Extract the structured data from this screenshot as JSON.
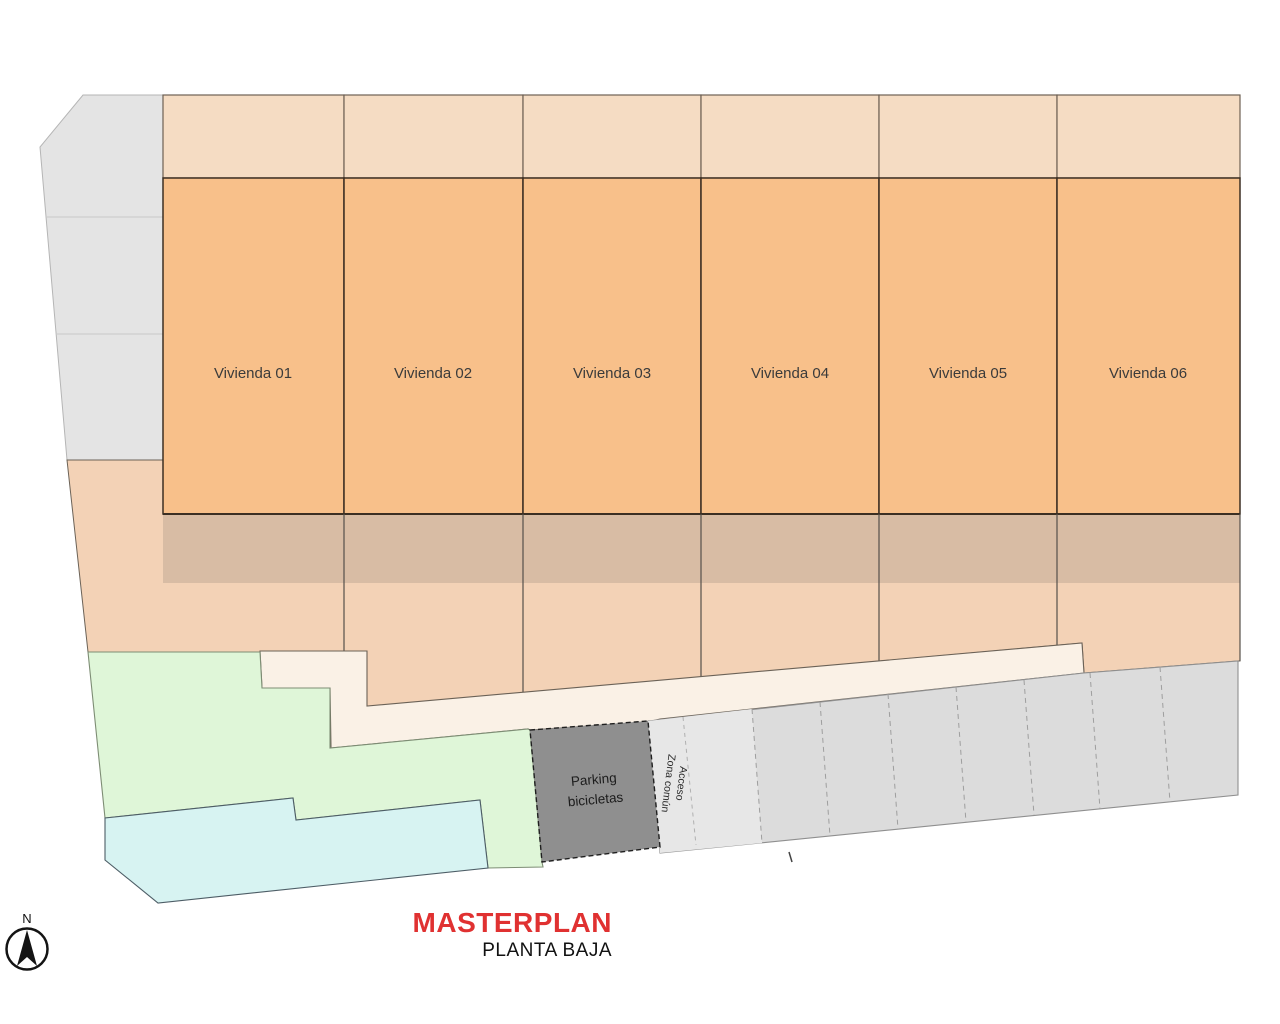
{
  "title": {
    "main": "MASTERPLAN",
    "subtitle": "PLANTA BAJA"
  },
  "compass": {
    "north_label": "N"
  },
  "units": [
    {
      "label": "Vivienda 01"
    },
    {
      "label": "Vivienda 02"
    },
    {
      "label": "Vivienda 03"
    },
    {
      "label": "Vivienda 04"
    },
    {
      "label": "Vivienda 05"
    },
    {
      "label": "Vivienda 06"
    }
  ],
  "bike_parking": {
    "line1": "Parking",
    "line2": "bicicletas"
  },
  "access": {
    "line1": "Acceso",
    "line2": "Zona común"
  },
  "colors": {
    "unit_fill": "#f8c08a",
    "upper_strip_fill": "#f5dcc3",
    "terrace_band_fill": "#d8bca4",
    "garden_fill": "#f3d2b6",
    "walkway_fill": "#faf1e6",
    "green_fill": "#dff6d8",
    "pool_fill": "#d7f3f2",
    "plot_gray_fill": "#e4e4e4",
    "parking_strip_fill": "#dcdcdc",
    "access_strip_fill": "#e7e7e7",
    "bike_box_fill": "#8f8f8f",
    "outline_dark": "#3c2f23",
    "title_red": "#e03131"
  }
}
